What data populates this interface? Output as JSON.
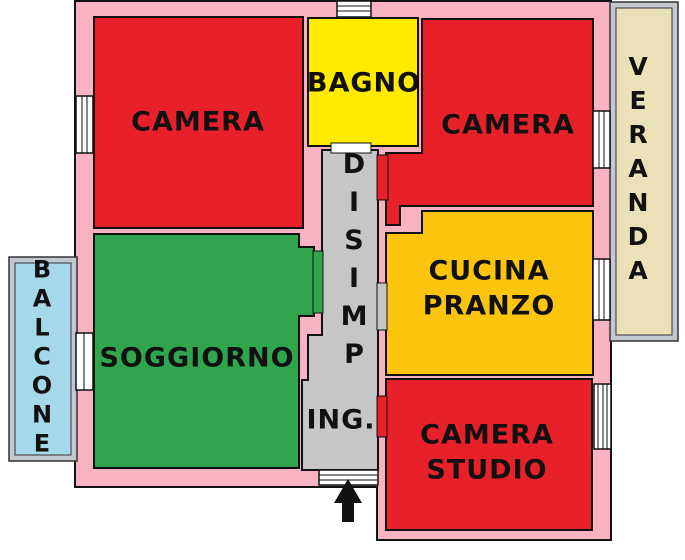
{
  "floor_plan": {
    "background_color": "#ffffff",
    "wall_color": "#F8B3C3",
    "outline_color": "#111111",
    "frame_color": "#C3C8CE",
    "window_color": "#ffffff",
    "rooms": {
      "camera_top_left": {
        "label": "CAMERA",
        "color": "#E8202A"
      },
      "bagno": {
        "label": "BAGNO",
        "color": "#FFEA00"
      },
      "camera_top_right": {
        "label": "CAMERA",
        "color": "#E8202A"
      },
      "cucina_pranzo": {
        "label": "CUCINA\nPRANZO",
        "color": "#FBC40D"
      },
      "soggiorno": {
        "label": "SOGGIORNO",
        "color": "#2FA54E"
      },
      "camera_studio": {
        "label": "CAMERA\nSTUDIO",
        "color": "#E8202A"
      },
      "disimpegno": {
        "label": "DISIMP",
        "color": "#C6C6C6"
      },
      "ingresso": {
        "label": "ING.",
        "color": "#C6C6C6"
      },
      "balcone": {
        "label": "BALCONE",
        "color": "#A5D9E9"
      },
      "veranda": {
        "label": "VERANDA",
        "color": "#EBE1B8"
      }
    },
    "entrance": {
      "arrow_direction": "up",
      "arrow_color": "#111111"
    }
  }
}
